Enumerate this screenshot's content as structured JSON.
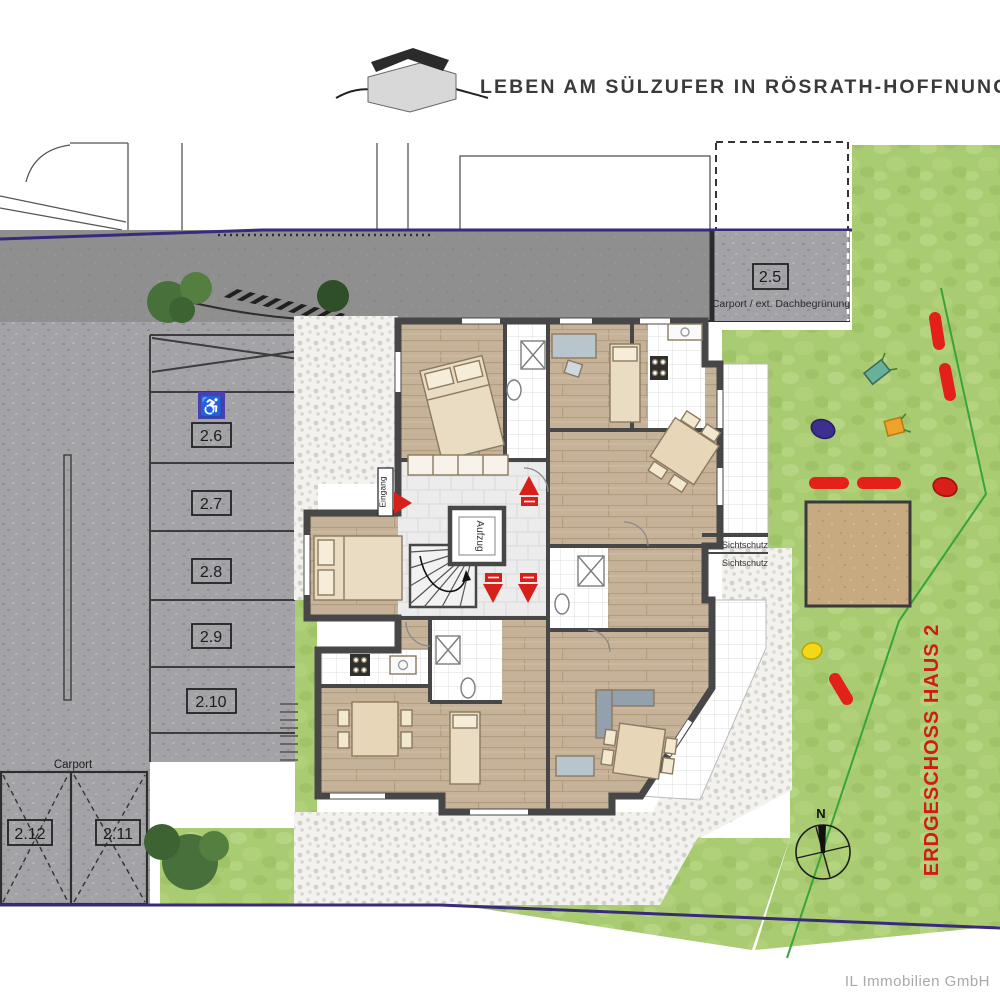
{
  "header": {
    "title": "LEBEN AM SÜLZUFER IN RÖSRATH-HOFFNUNGSTHAL"
  },
  "plan": {
    "floor_label": "ERDGESCHOSS HAUS 2",
    "elevator_label": "Aufzug",
    "entrance_label": "Eingang",
    "privacy_label_1": "Sichtschutz",
    "privacy_label_2": "Sichtschutz",
    "compass_label": "N"
  },
  "parking": {
    "roof_stall": {
      "id": "2.5",
      "note": "Carport / ext. Dachbegrünung"
    },
    "accessible_icon": "wheelchair-icon",
    "stalls": [
      {
        "id": "2.6"
      },
      {
        "id": "2.7"
      },
      {
        "id": "2.8"
      },
      {
        "id": "2.9"
      },
      {
        "id": "2.10"
      }
    ],
    "carport": {
      "label": "Carport",
      "left_stall": "2.12",
      "right_stall": "2.11"
    }
  },
  "footer": {
    "company": "IL Immobilien GmbH"
  },
  "colors": {
    "lawn": "#a9cc72",
    "road": "#8f8f8f",
    "paving": "#a2a2a6",
    "wall": "#474747",
    "accent_red": "#d8201a",
    "boundary_purple": "#392a7c",
    "accessible_blue": "#4b3fae",
    "sand": "#c8aa81"
  }
}
